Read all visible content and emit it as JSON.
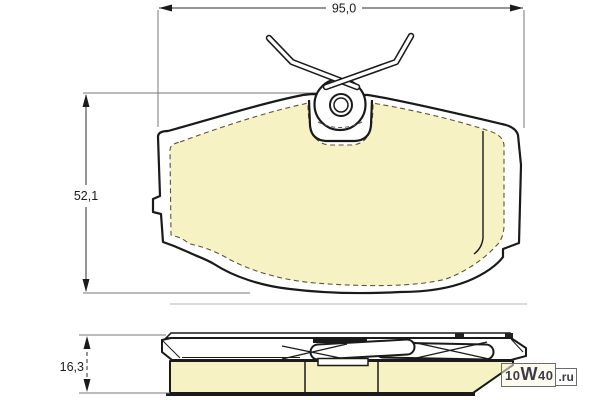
{
  "drawing": {
    "title": "brake-pad-technical-drawing",
    "dimensions": {
      "width_label": "95,0",
      "height_label": "52,1",
      "thickness_label": "16,3"
    },
    "watermark": {
      "site_prefix": "10",
      "site_w": "W",
      "site_suffix": "40",
      "tld": ".ru"
    },
    "colors": {
      "friction_material": "#f7f2c4",
      "outline": "#1a1a1a",
      "dimension_lines": "#2b2b2b",
      "extension_lines": "#777777",
      "background": "#ffffff"
    }
  }
}
